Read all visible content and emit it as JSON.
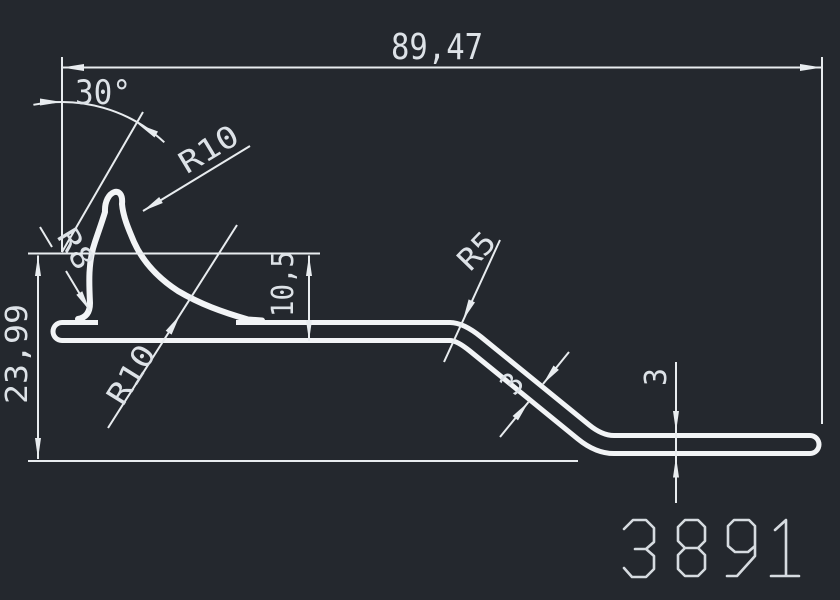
{
  "app": {
    "view": "cad-drawing-viewport",
    "colors": {
      "background": "#24282e",
      "profile_line": "#f2f4f6",
      "dimension_line": "#e8ecef",
      "text": "#dde2e7",
      "part_number": "#d6dbe0"
    }
  },
  "drawing": {
    "part_number": "3891",
    "shape": "bent sheet extrusion profile with top hook curl, sloped web and bottom flange",
    "dimensions": {
      "overall_width": "89,47",
      "overall_height": "23,99",
      "lip_height": "10,5",
      "hook_angle": "30°",
      "hook_radius_top": "R10",
      "hook_radius_bottom": "R10",
      "lip_radius": "R8",
      "bend_radius": "R5",
      "web_thickness": "3",
      "flange_thickness": "3"
    }
  }
}
